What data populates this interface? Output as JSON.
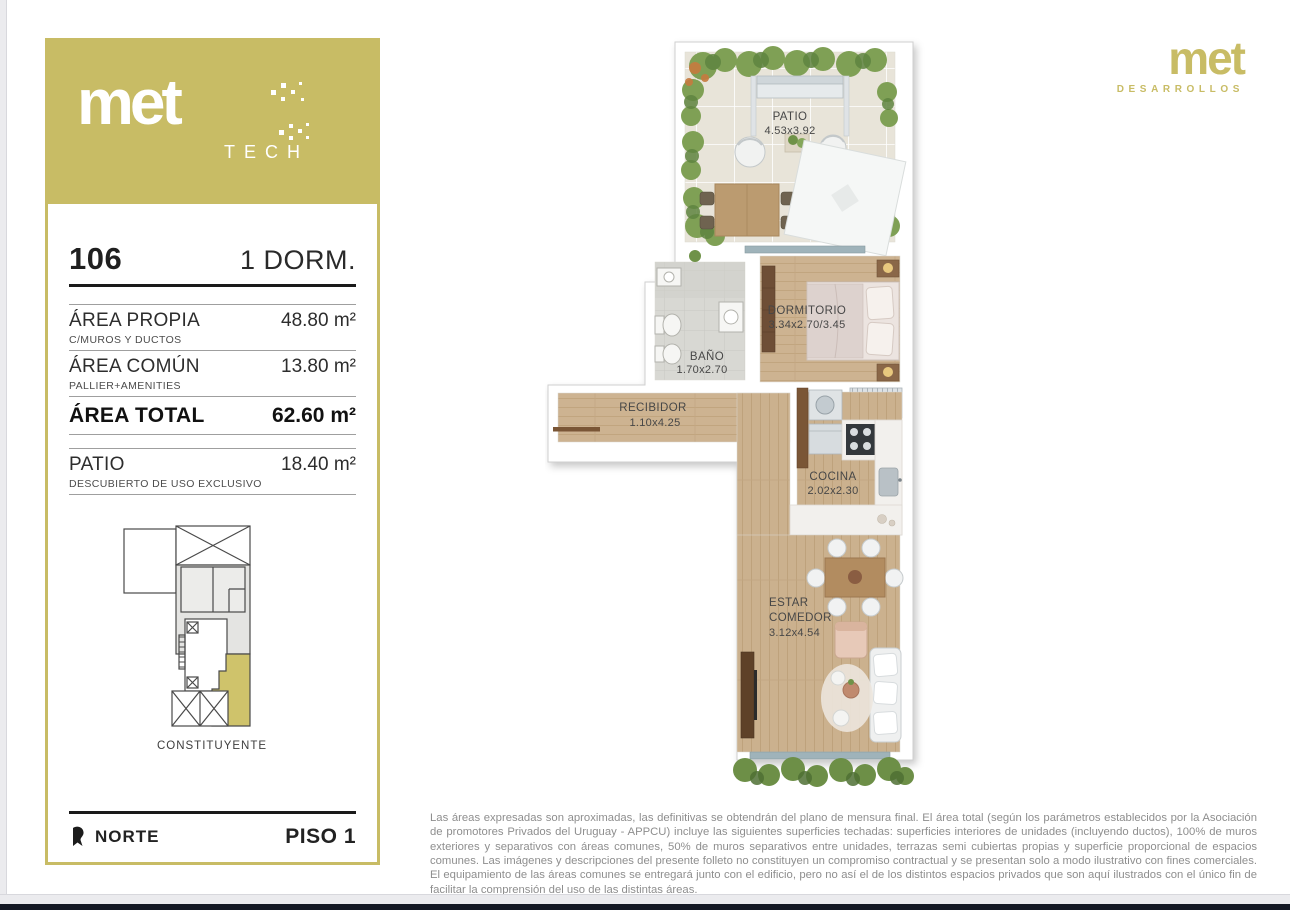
{
  "colors": {
    "gold": "#c8bc65",
    "ink": "#1f1f1f",
    "muted": "#8e8e8e",
    "line": "#9f9f9f",
    "dark-bar": "#141824"
  },
  "sidebar": {
    "logo": {
      "brand": "met",
      "sub": "TECH"
    },
    "unit": {
      "number": "106",
      "type": "1 DORM."
    },
    "areas": [
      {
        "label": "ÁREA PROPIA",
        "value": "48.80 m²",
        "note": "C/MUROS Y DUCTOS"
      },
      {
        "label": "ÁREA COMÚN",
        "value": "13.80 m²",
        "note": "PALLIER+AMENITIES"
      },
      {
        "label": "ÁREA TOTAL",
        "value": "62.60 m²",
        "note": ""
      },
      {
        "label": "PATIO",
        "value": "18.40 m²",
        "note": "DESCUBIERTO DE USO EXCLUSIVO"
      }
    ],
    "siteplan": {
      "street": "CONSTITUYENTE"
    },
    "footer": {
      "north": "NORTE",
      "floor": "PISO 1"
    }
  },
  "header_logo": {
    "brand": "met",
    "sub": "DESARROLLOS"
  },
  "floorplan": {
    "rooms": [
      {
        "name": "PATIO",
        "dims": "4.53x3.92"
      },
      {
        "name": "DORMITORIO",
        "dims": "3.34x2.70/3.45"
      },
      {
        "name": "BAÑO",
        "dims": "1.70x2.70"
      },
      {
        "name": "RECIBIDOR",
        "dims": "1.10x4.25"
      },
      {
        "name": "COCINA",
        "dims": "2.02x2.30"
      },
      {
        "name": "ESTAR",
        "name2": "COMEDOR",
        "dims": "3.12x4.54"
      }
    ]
  },
  "disclaimer": "Las áreas expresadas son aproximadas, las definitivas se obtendrán del plano de mensura final. El área total (según los parámetros establecidos por la Asociación de promotores Privados del Uruguay - APPCU) incluye las siguientes superficies techadas: superficies interiores de unidades (incluyendo ductos), 100% de muros exteriores y separativos con áreas comunes, 50% de muros separativos entre unidades, terrazas semi cubiertas propias y superficie proporcional de espacios comunes.  Las imágenes y descripciones del presente folleto no constituyen un compromiso contractual y se presentan solo a modo ilustrativo con fines comerciales. El equipamiento de las áreas comunes se entregará junto con el edificio, pero no así el de los distintos espacios privados que son aquí ilustrados con el único fin de facilitar la comprensión del uso de las distintas áreas."
}
